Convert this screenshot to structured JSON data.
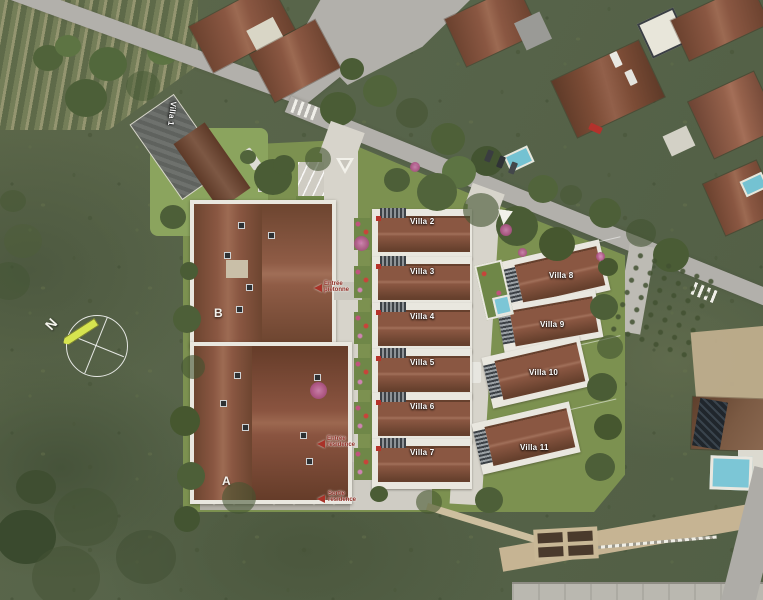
{
  "map": {
    "villas": [
      {
        "label": "Villa 1"
      },
      {
        "label": "Villa 2"
      },
      {
        "label": "Villa 3"
      },
      {
        "label": "Villa 4"
      },
      {
        "label": "Villa 5"
      },
      {
        "label": "Villa 6"
      },
      {
        "label": "Villa 7"
      },
      {
        "label": "Villa 8"
      },
      {
        "label": "Villa 9"
      },
      {
        "label": "Villa 10"
      },
      {
        "label": "Villa 11"
      }
    ],
    "buildings": [
      {
        "label": "B"
      },
      {
        "label": "A"
      }
    ],
    "compass": {
      "north": "N"
    },
    "annotations": {
      "pedestrian_entrance": {
        "line1": "Entrée",
        "line2": "piétonne"
      },
      "residence_entrance": {
        "line1": "Entrée",
        "line2": "résidence"
      },
      "residence_exit": {
        "line1": "Sortie",
        "line2": "résidence"
      }
    },
    "colors": {
      "roof_brown": "#8a5742",
      "lane_gray": "#d7d4cb",
      "lawn_green": "#7c9150",
      "field_green": "#5a654a",
      "pool_blue": "#7cc6d6",
      "north_needle": "#d6e44f",
      "annotation_red": "#a93228"
    }
  }
}
